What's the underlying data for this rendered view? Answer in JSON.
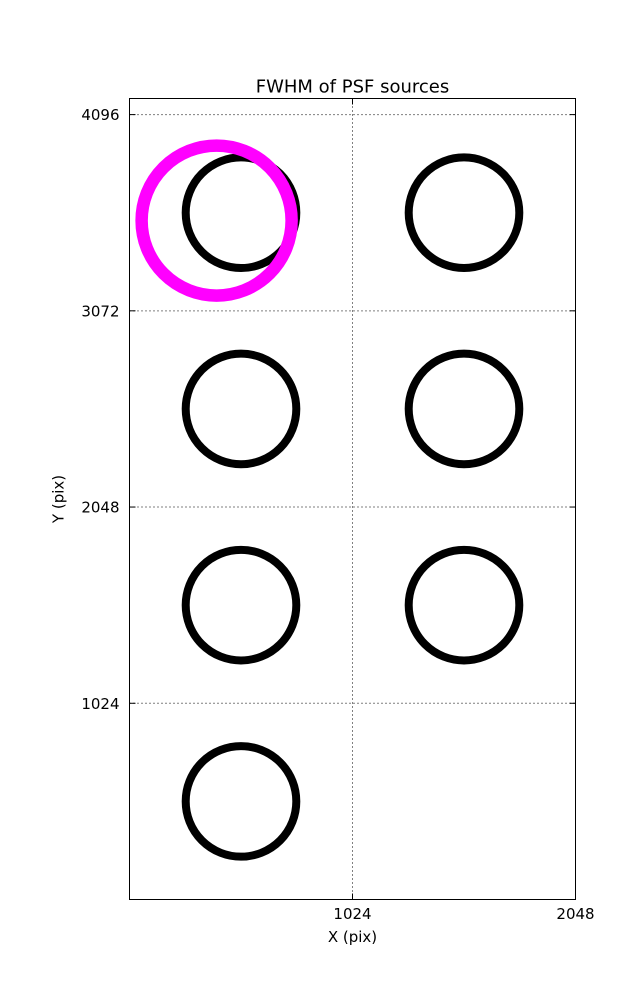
{
  "figure": {
    "background": "#ffffff",
    "frame_color": "#000000"
  },
  "chart_data": {
    "type": "scatter",
    "title": "FWHM of PSF sources",
    "xlabel": "X (pix)",
    "ylabel": "Y (pix)",
    "xlim": [
      0,
      2048
    ],
    "ylim": [
      0,
      4180
    ],
    "xticks": [
      1024,
      2048
    ],
    "yticks": [
      1024,
      2048,
      3072,
      4096
    ],
    "grid": "dotted",
    "grid_color": "#000000",
    "legend": "none",
    "series": [
      {
        "name": "psf-source",
        "label": "PSF sources",
        "color": "#000000",
        "marker": "open-circle",
        "marker_radius_px": 55.3,
        "stroke_px": 8,
        "points": [
          {
            "x": 512,
            "y": 3584
          },
          {
            "x": 1536,
            "y": 3584
          },
          {
            "x": 512,
            "y": 2560
          },
          {
            "x": 1536,
            "y": 2560
          },
          {
            "x": 512,
            "y": 1536
          },
          {
            "x": 1536,
            "y": 1536
          },
          {
            "x": 512,
            "y": 512
          }
        ]
      },
      {
        "name": "flagged-psf-source",
        "label": "Flagged source",
        "color": "#FF00FF",
        "marker": "open-circle",
        "marker_radius_px": 75,
        "stroke_px": 12.5,
        "points": [
          {
            "x": 400,
            "y": 3543
          }
        ]
      }
    ]
  }
}
